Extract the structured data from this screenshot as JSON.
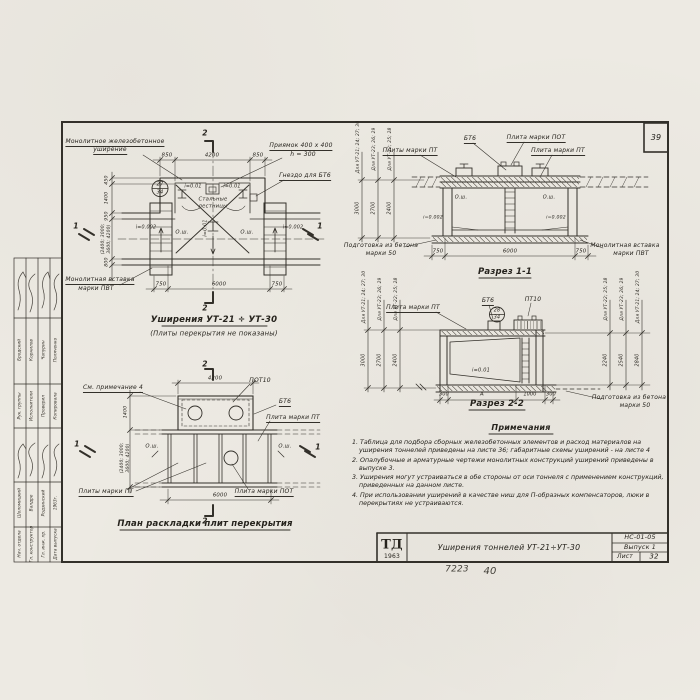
{
  "sheet": {
    "corner_number": "39",
    "footer_number": "7223",
    "footer_number2": "40"
  },
  "title_block": {
    "logo": "ТД",
    "logo_year": "1963",
    "title": "Уширения тоннелей УТ-21÷УТ-30",
    "code": "НС-01-05",
    "issue": "Выпуск 1",
    "sheet_label": "Лист",
    "sheet_number": "32"
  },
  "stamp": {
    "group1": {
      "roles": [
        "Рук. группы",
        "Исполнители",
        "Проверил",
        "Копировала"
      ],
      "names": [
        "Бродский",
        "Корнилов",
        "Чапурин",
        "Поляченко"
      ]
    },
    "group2": {
      "roles": [
        "Нач. отдела",
        "Гл. конструктор",
        "Гл. инж. пр.",
        "Дата выпуска"
      ],
      "names": [
        "Шоломицкий",
        "Валдре",
        "Родзинский",
        "1963г."
      ]
    }
  },
  "plan_widening": {
    "title": "Уширения УТ-21 ÷ УТ-30",
    "subtitle": "(Плиты перекрытия не показаны)",
    "label_monolithic_1": "Монолитное железобетонное",
    "label_monolithic_2": "уширение",
    "label_pit_1": "Приямок 400 x 400",
    "label_pit_2": "h = 300",
    "label_socket": "Гнездо для БТ6",
    "label_ladders_1": "Стальные",
    "label_ladders_2": "лестницы",
    "label_insert_1": "Монолитная вставка",
    "label_insert_2": "марки ПВТ",
    "detail_num": "27",
    "detail_sheet": "34",
    "slope_left": "i=0.01",
    "slope_right": "i=0.01",
    "slope_axis": "i=0.01",
    "slope_wall_left": "i=0.002",
    "slope_wall_right": "i=0.002",
    "axis_left": "О.ш.",
    "axis_right": "О.ш.",
    "dim_top": [
      "850",
      "4200",
      "850"
    ],
    "dim_bottom": [
      "750",
      "6000",
      "750"
    ],
    "dim_left": [
      "450",
      "1400",
      "950",
      "(2400; 3000;",
      "3600; 4200)",
      "800"
    ],
    "mark_1": "1",
    "mark_2": "2"
  },
  "section_1_1": {
    "title": "Разрез 1-1",
    "label_bt6": "БТ6",
    "label_pot": "Плита марки ПОТ",
    "label_pt_left": "Плиты марки ПТ",
    "label_pt_right": "Плита марки ПТ",
    "label_prep_1": "Подготовка из бетона",
    "label_prep_2": "марки 50",
    "label_insert_1": "Монолитная вставка",
    "label_insert_2": "марки ПВТ",
    "axis_left": "О.ш.",
    "axis_right": "О.ш.",
    "slope_left": "i=0.002",
    "slope_right": "i=0.002",
    "chain_labels": [
      "Для УТ-21; 24; 27; 30",
      "Для УТ-23; 26; 29",
      "Для УТ-22; 25; 28"
    ],
    "chain_values": [
      "3000",
      "2700",
      "2400"
    ],
    "dim_bottom": [
      "750",
      "6000",
      "750"
    ]
  },
  "section_2_2": {
    "title": "Разрез 2-2",
    "label_pt": "Плита марки ПТ",
    "label_bt6": "БТ6",
    "label_pt10": "ПТ10",
    "detail_num": "28",
    "detail_sheet": "34",
    "slope": "i=0.01",
    "label_prep_1": "Подготовка из бетона",
    "label_prep_2": "марки 50",
    "chain_left_labels": [
      "Для УТ-21; 24; 27; 30",
      "Для УТ-23; 26; 29",
      "Для УТ-22; 25; 28"
    ],
    "chain_left_values": [
      "3000",
      "2700",
      "2400"
    ],
    "chain_right_labels": [
      "Для УТ-22; 25; 28",
      "Для УТ-23; 26; 29",
      "Для УТ-21; 24; 27; 30"
    ],
    "chain_right_values": [
      "2240",
      "2540",
      "2840"
    ],
    "dim_bottom": [
      "300",
      "А",
      "1000",
      "300"
    ]
  },
  "plan_slabs": {
    "title": "План раскладки плит перекрытия",
    "label_see_note": "См. примечание 4",
    "label_pot10": "ПОТ10",
    "label_bt6": "БТ6",
    "label_pt": "Плита марки ПТ",
    "label_pt_plural": "Плиты марки ПТ",
    "label_pot": "Плита марки ПОТ",
    "axis_left": "О.ш.",
    "axis_right": "О.ш.",
    "dim_top": "4200",
    "dim_bottom": "6000",
    "dim_left": [
      "1400",
      "(2400; 3000;",
      "3600; 4200)"
    ],
    "mark_1": "1",
    "mark_2": "2"
  },
  "notes": {
    "heading": "Примечания",
    "items": [
      "1. Таблица для подбора сборных железобетонных элементов и расход материалов на уширения тоннелей приведены на листе 36; габаритные схемы уширений - на листе 4",
      "2. Опалубочные и арматурные чертежи монолитных конструкций уширений приведены в выпуске 3.",
      "3. Уширения могут устраиваться в обе стороны от оси тоннеля с применением конструкций, приведенных на данном листе.",
      "4. При использовании уширений в качестве ниш для П-образных компенсаторов, люки в перекрытиях не устраиваются."
    ]
  },
  "colors": {
    "paper": "#edeae3",
    "ink": "#33302a"
  }
}
